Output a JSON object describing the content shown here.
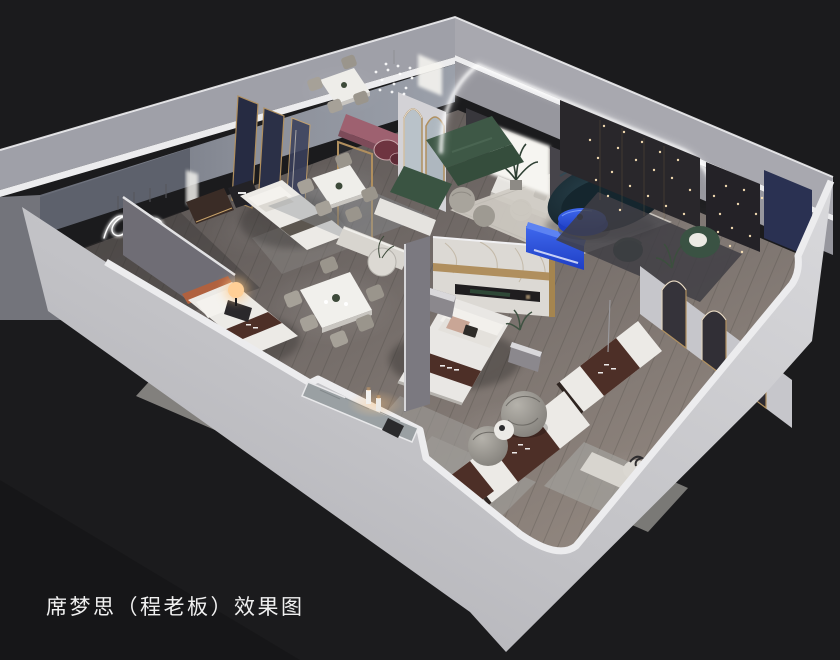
{
  "caption": {
    "text": "席梦思（程老板）效果图"
  },
  "scene": {
    "type": "3d-interior-cutaway-render",
    "description": "Isometric cutaway rendering of a Simmons mattress showroom with bedroom displays, dining sets, lounge and mattress exhibits",
    "areas": [
      {
        "name": "west-nook",
        "label": "corner nook with squiggle wall light"
      },
      {
        "name": "bedroom-nook-1",
        "label": "bed display with navy fabric panels"
      },
      {
        "name": "dining-area",
        "label": "three marble dining sets with chairs"
      },
      {
        "name": "master-bed-area",
        "label": "bed with marble headboard wall"
      },
      {
        "name": "lounge-area",
        "label": "arched lounge with green sofa, navy sofa and blue table"
      },
      {
        "name": "dark-display-room",
        "label": "dark feature room with fairy lights and green armchair"
      },
      {
        "name": "arch-mirror-wall",
        "label": "wall with arched mirrors"
      },
      {
        "name": "mattress-display",
        "label": "branded mattress exhibits with barrel chairs"
      },
      {
        "name": "bedroom-left",
        "label": "bedroom with terracotta bed and glowing lamp"
      }
    ]
  },
  "colors": {
    "bg": "#1b1b1d",
    "wallFront": "#c9c9cd",
    "wallBand": "#9fa0a8",
    "wallRim": "#ececee",
    "wallInterior": "#8b8f99",
    "floorDark": "#4f4a49",
    "floorMid": "#6f6865",
    "floorLight": "#958a82",
    "navyPanel": "#2b3047",
    "marble": "#dcd9d4",
    "gold": "#b08f5e",
    "greenSofa": "#3e5846",
    "tealSofa": "#111e26",
    "accentBlue": "#3f68ee",
    "accentBlueDeep": "#1e3ec4",
    "runnerBrown": "#4d2f27",
    "mattressWhite": "#eceae6",
    "rugCream": "#cfcbc3",
    "rugGray": "#9c9a96",
    "rose": "#9e6170",
    "terracotta": "#b0613f",
    "darkPanel": "#29272b",
    "navyWall": "#2a3152",
    "glowWarm": "#ffcf96",
    "captionColor": "#f0f0f0"
  }
}
